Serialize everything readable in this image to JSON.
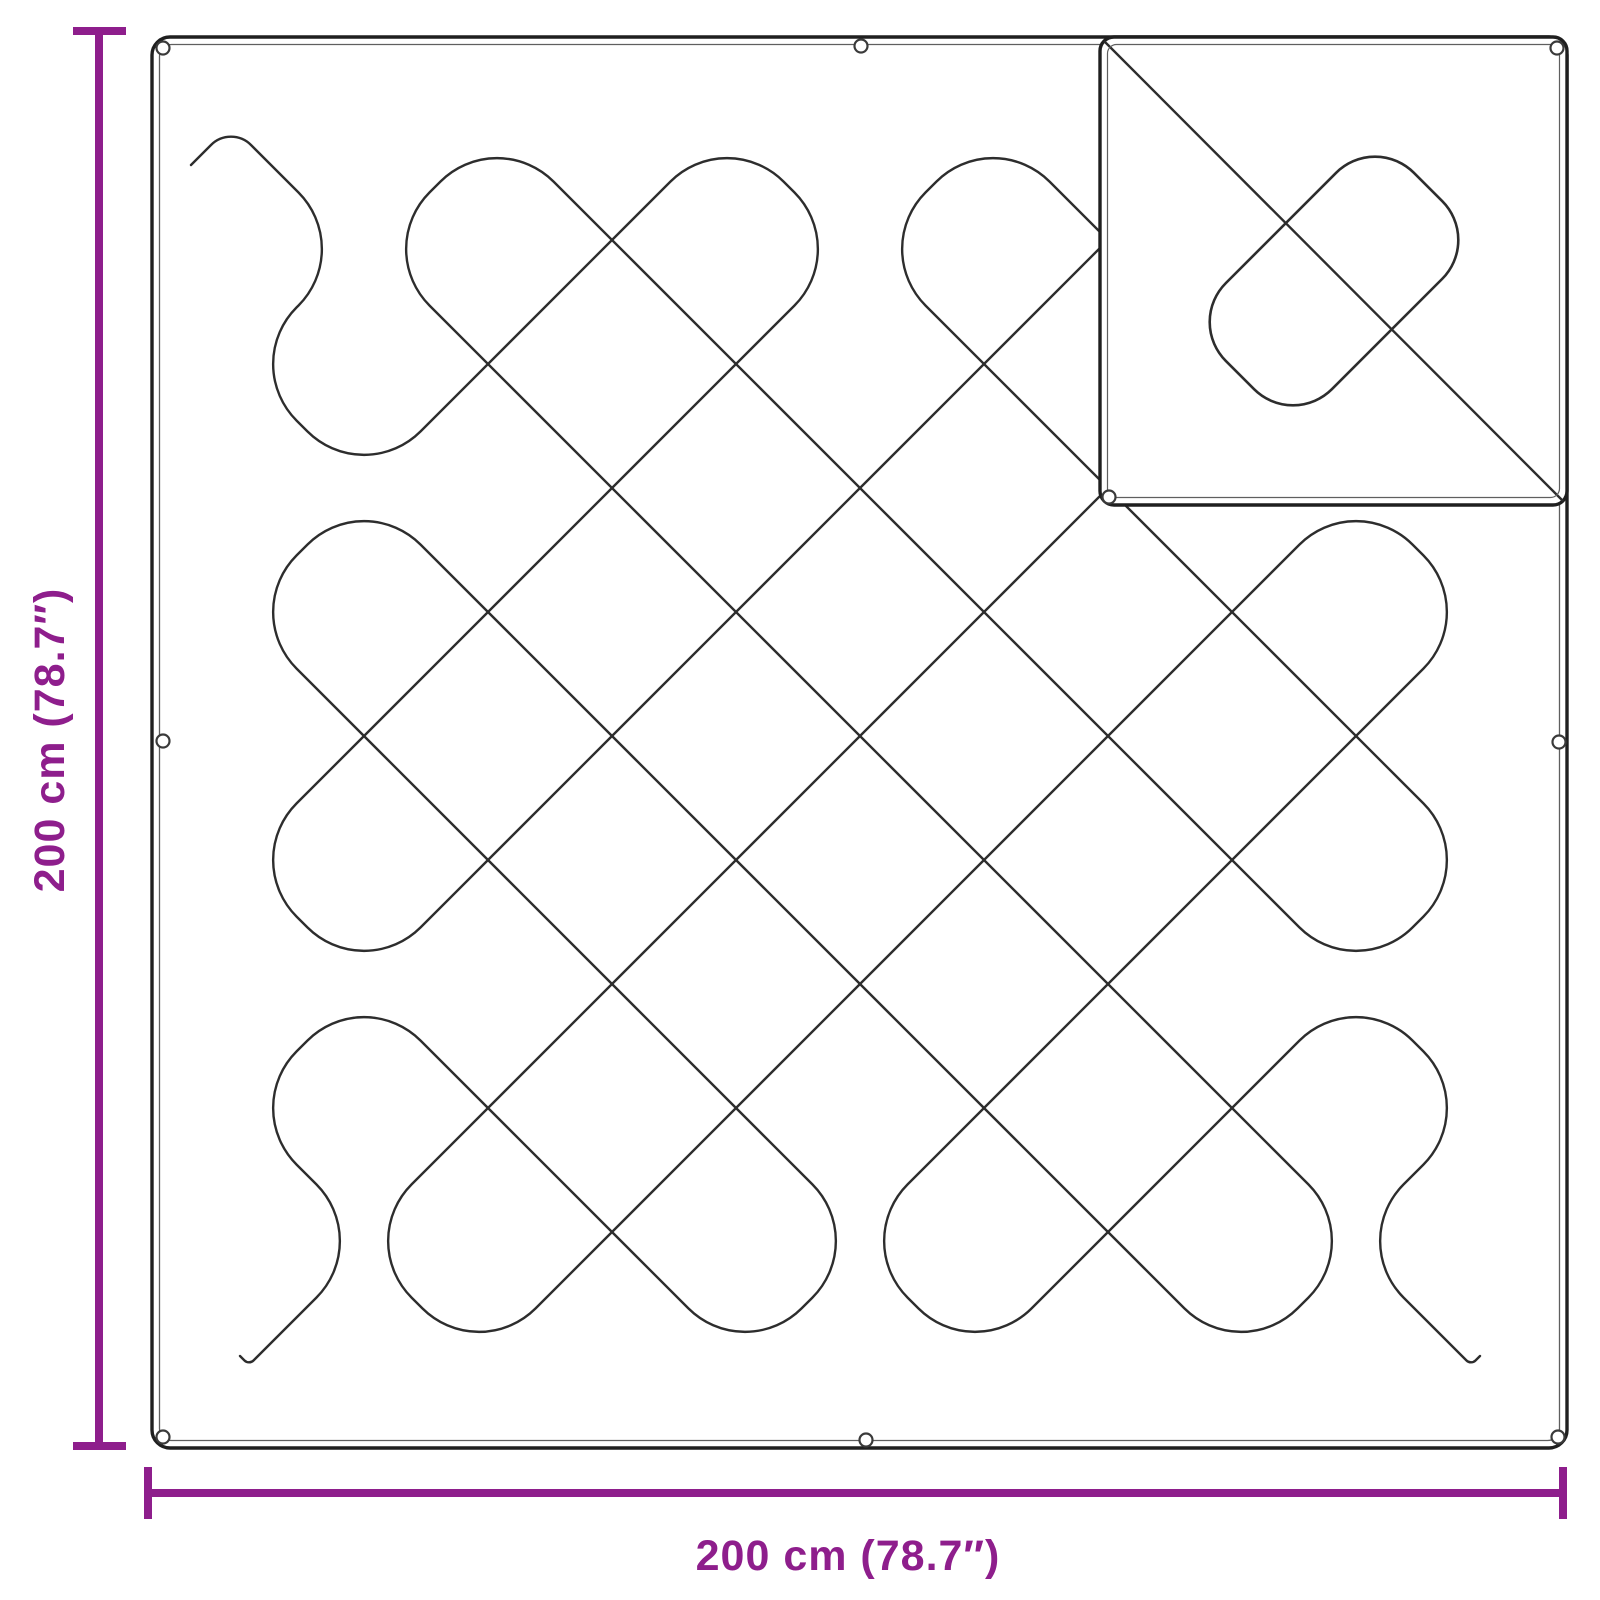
{
  "diagram": {
    "product": "quilted-blanket-with-grommets",
    "height_dimension_label": "200 cm (78.7″)",
    "width_dimension_label": "200 cm (78.7″)",
    "grommets_visible": 9,
    "colors": {
      "accent": "#8E1E8C",
      "stitch": "#2d2d2d",
      "outline": "#1f1f1f",
      "hem": "#5f5f5f",
      "background": "#ffffff"
    }
  }
}
